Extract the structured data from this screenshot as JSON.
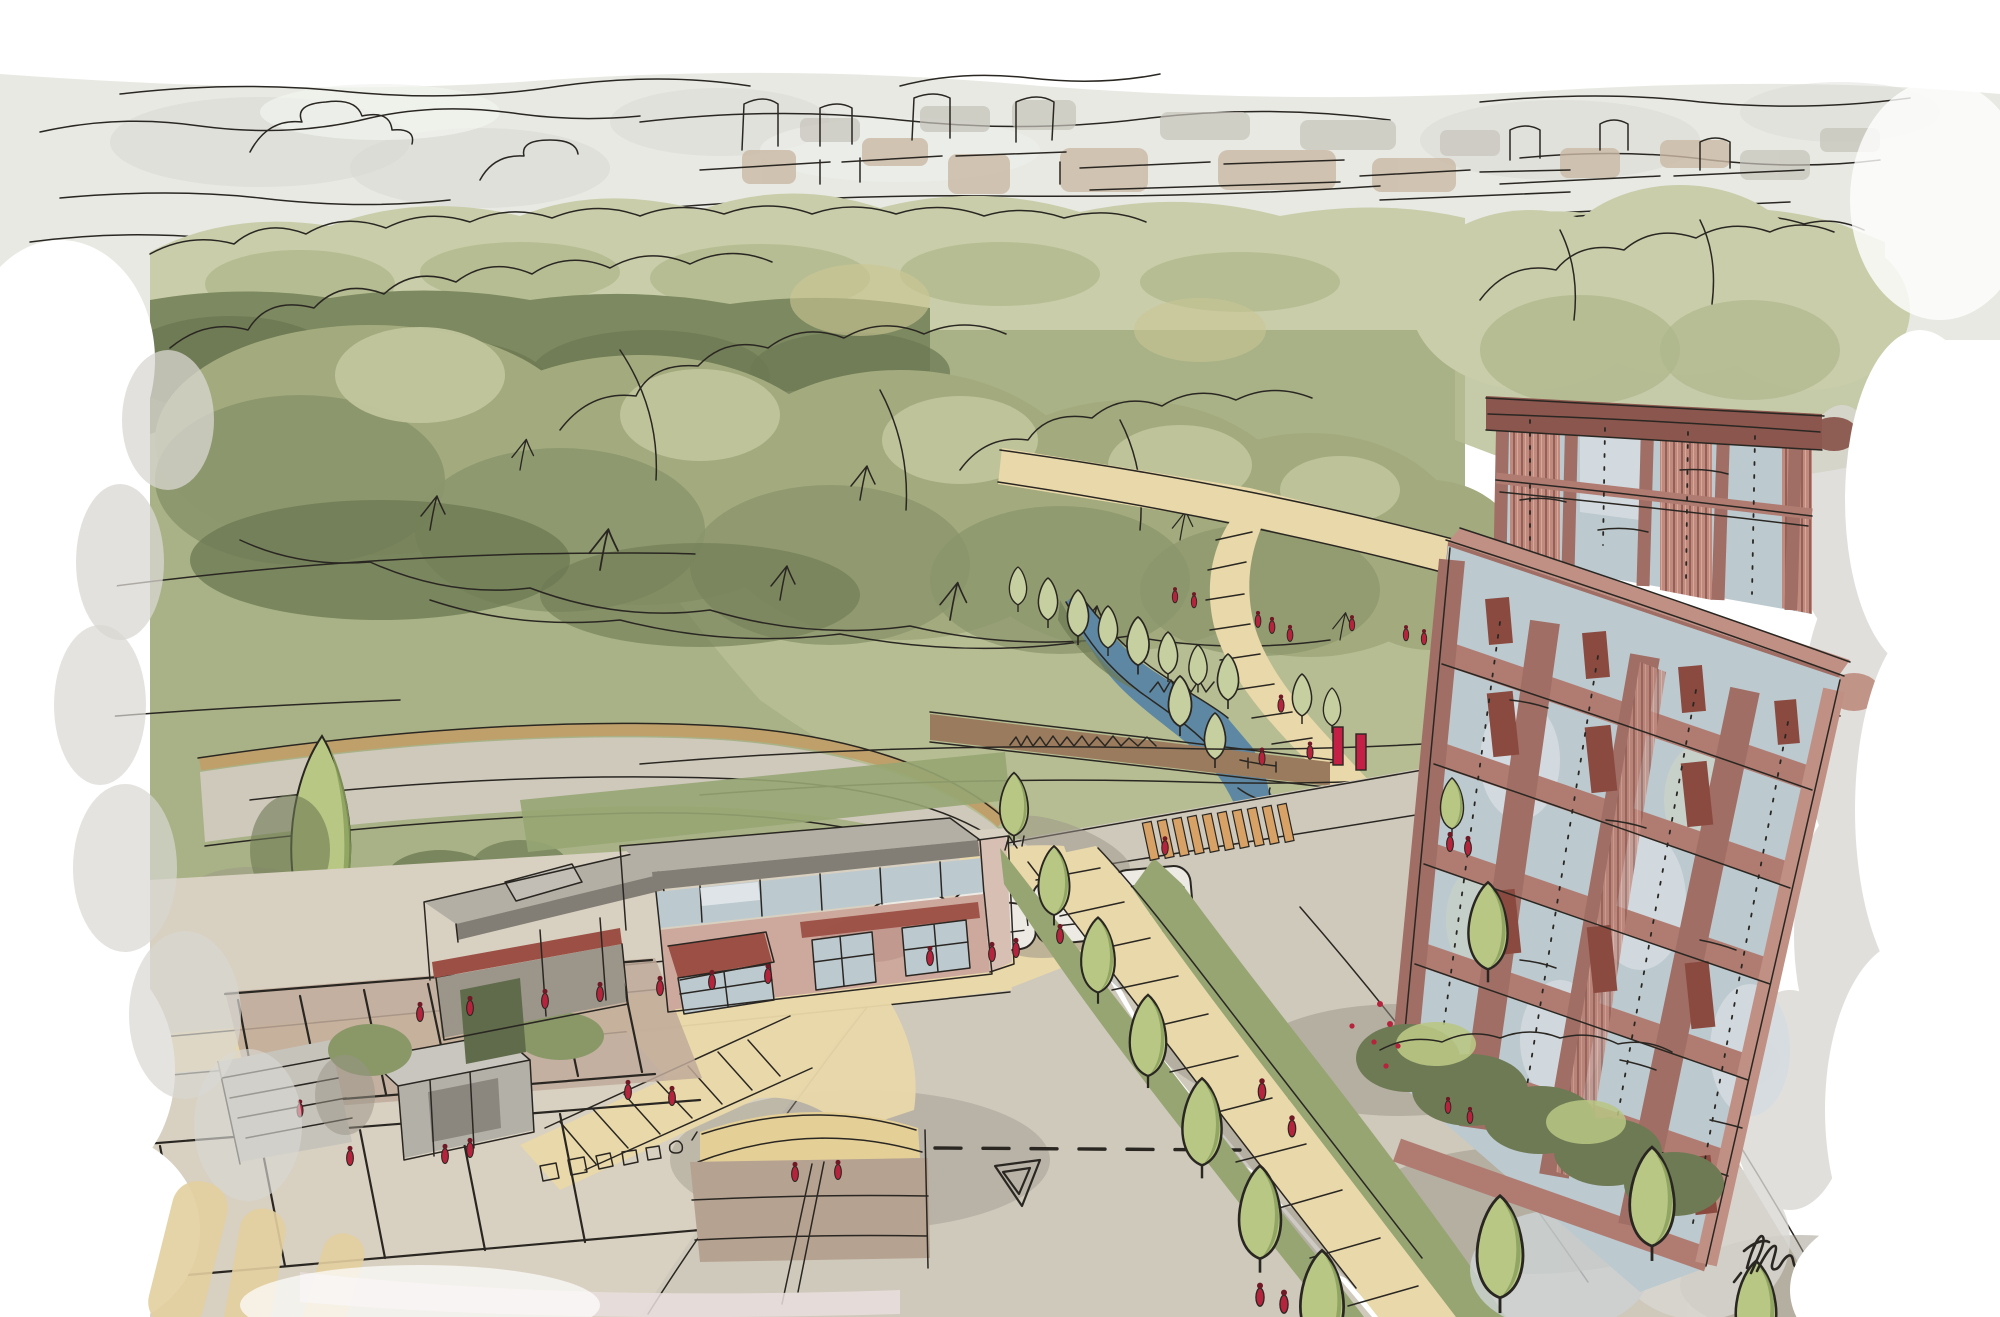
{
  "scene": {
    "title": "Hand-drawn aerial architectural concept sketch of a riverside park development",
    "description": "Digital sketch, aerial perspective: distant city skyline above woodland belts; a meadow with a winding footpath, stream and footbridge; a low retail pavilion with red awnings, parking court and pedestrian crossings; a tree-lined avenue leading to a tall red-brick residential tower with a gridded glass facade; loose watercolour-style washes fading to white at the edges.",
    "signature": "illegible artist signature scribble (bottom right)"
  },
  "counts": {
    "tower_visible_floor_bands": 6,
    "tower_window_bays": 4,
    "avenue_street_trees": 7,
    "parked_cars": 4
  },
  "palette": {
    "ink": "#2a2722",
    "sky": "#e7e9e2",
    "cloud": "#d7d8d2",
    "cityTan": "#cbb9a5",
    "cityGray": "#c6c3ba",
    "treeFar": "#c9cda9",
    "treeFarShade": "#aeb68a",
    "canopy": "#a3ab7e",
    "canopyShade": "#8b956c",
    "canopyDark": "#6e7a54",
    "canopyDeep": "#7d8960",
    "canopyLight": "#c2c59d",
    "highlight": "#cbc795",
    "field": "#a9b286",
    "meadow": "#b6bd92",
    "verge": "#96a572",
    "treeLight": "#b9c784",
    "treeDark": "#8aa05c",
    "bankTree": "#c6cf9f",
    "pathTan": "#e9d8a9",
    "pathEdge": "#bfa06b",
    "crossOrange": "#d8a266",
    "roadGray": "#cfc9bc",
    "pave": "#d8d0c0",
    "shadow": "#9a9488",
    "parkBrown": "#c0aa9a",
    "wallPink": "#cda89d",
    "wallPinkDark": "#b98f85",
    "roofGray": "#b3afa5",
    "roofDark": "#827e76",
    "fasciaRed": "#9c4f44",
    "glass": "#bcc9cf",
    "glassPale": "#d5dce0",
    "water": "#5d87a2",
    "bridge": "#9b7b5e",
    "brick": "#a06e64",
    "brickLight": "#c09084",
    "brickBand": "#b07c72",
    "brickDark": "#8a564e",
    "spandrel": "#8a4a40",
    "louver": "#c08a7f",
    "louverLine": "#8a564e",
    "peopleRed": "#b5243c",
    "peopleHead": "#6f1826",
    "washGray": "#d9d7d2",
    "fadePink": "#e9dedd",
    "fadeTan": "#e3cfa0",
    "white": "#ffffff"
  }
}
